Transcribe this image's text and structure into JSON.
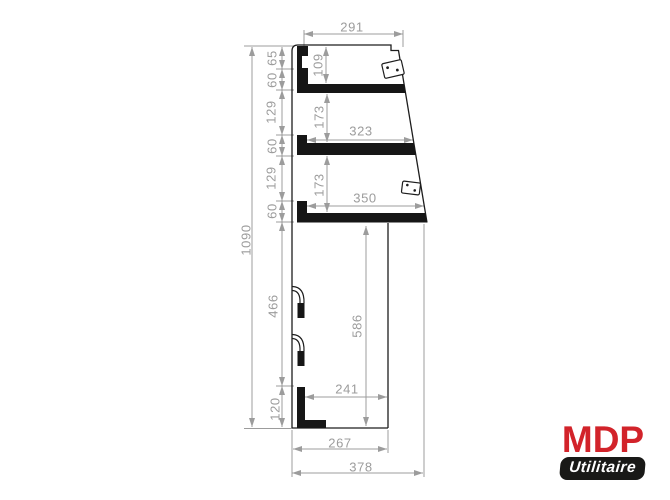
{
  "drawing_type": "technical-dimension-drawing",
  "dims": {
    "overall_height": "1090",
    "left_chain": [
      "65",
      "60",
      "129",
      "60",
      "129",
      "60",
      "466",
      "120"
    ],
    "top_width": "291",
    "top_shelf_depth": "109",
    "shelf_gap_upper": "173",
    "shelf2_width": "323",
    "shelf_gap_lower": "173",
    "shelf3_width": "350",
    "lower_section_height": "586",
    "bottom_inner_width": "241",
    "bottom_width": "267",
    "overall_depth": "378"
  },
  "logo": {
    "brand": "MDP",
    "product_line": "Utilitaire"
  },
  "colors": {
    "brand_red": "#d2232a",
    "pill_black": "#191917",
    "dim_gray": "#9c9c9c",
    "ink_black": "#1d1d1d"
  }
}
